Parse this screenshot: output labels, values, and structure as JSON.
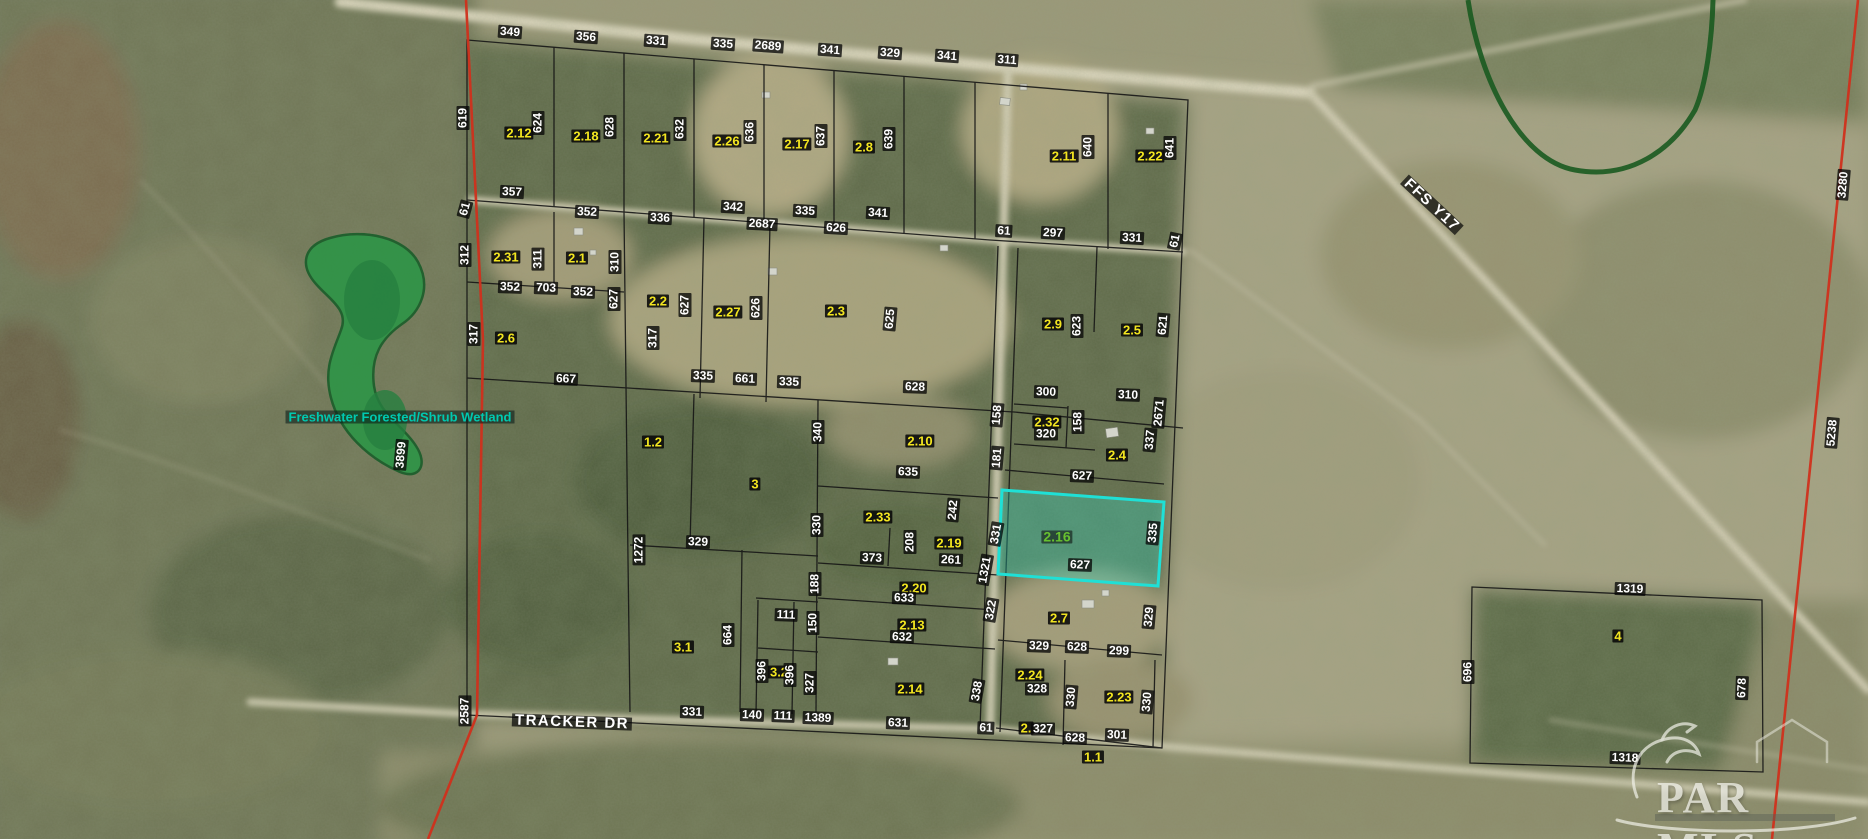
{
  "map": {
    "description": "Aerial parcel map with platted subdivision, section lines and wetland overlay",
    "highlighted_parcel": "2.16",
    "highlight_color": "#1fe0d6",
    "parcel_number_color": "#f2e520",
    "dimension_color": "#ffffff",
    "wetland": {
      "label": "Freshwater Forested/Shrub Wetland",
      "fill_color": "#2f9447",
      "label_color": "#00c9b0"
    },
    "roads": {
      "tracker": "TRACKER DR",
      "ffs": "FFS Y17"
    },
    "watermark": {
      "text": "PAR MLS"
    }
  },
  "labels": [
    {
      "t": "349",
      "x": 510,
      "y": 32,
      "r": 4,
      "s": "dim"
    },
    {
      "t": "356",
      "x": 586,
      "y": 37,
      "r": 4,
      "s": "dim"
    },
    {
      "t": "331",
      "x": 656,
      "y": 41,
      "r": 4,
      "s": "dim"
    },
    {
      "t": "335",
      "x": 723,
      "y": 44,
      "r": 4,
      "s": "dim"
    },
    {
      "t": "2689",
      "x": 768,
      "y": 46,
      "r": 4,
      "s": "dim"
    },
    {
      "t": "341",
      "x": 830,
      "y": 50,
      "r": 4,
      "s": "dim"
    },
    {
      "t": "329",
      "x": 890,
      "y": 53,
      "r": 4,
      "s": "dim"
    },
    {
      "t": "341",
      "x": 947,
      "y": 56,
      "r": 4,
      "s": "dim"
    },
    {
      "t": "311",
      "x": 1007,
      "y": 60,
      "r": 4,
      "s": "dim"
    },
    {
      "t": "619",
      "x": 463,
      "y": 118,
      "r": -90,
      "s": "dim"
    },
    {
      "t": "2.12",
      "x": 519,
      "y": 133,
      "r": 0,
      "s": "parcel"
    },
    {
      "t": "624",
      "x": 538,
      "y": 123,
      "r": -90,
      "s": "dim"
    },
    {
      "t": "2.18",
      "x": 586,
      "y": 136,
      "r": 0,
      "s": "parcel"
    },
    {
      "t": "628",
      "x": 610,
      "y": 127,
      "r": -90,
      "s": "dim"
    },
    {
      "t": "2.21",
      "x": 656,
      "y": 138,
      "r": 0,
      "s": "parcel"
    },
    {
      "t": "632",
      "x": 680,
      "y": 129,
      "r": -90,
      "s": "dim"
    },
    {
      "t": "2.26",
      "x": 727,
      "y": 141,
      "r": 0,
      "s": "parcel"
    },
    {
      "t": "636",
      "x": 750,
      "y": 132,
      "r": -90,
      "s": "dim"
    },
    {
      "t": "2.17",
      "x": 797,
      "y": 144,
      "r": 0,
      "s": "parcel"
    },
    {
      "t": "637",
      "x": 821,
      "y": 136,
      "r": -90,
      "s": "dim"
    },
    {
      "t": "2.8",
      "x": 864,
      "y": 147,
      "r": 0,
      "s": "parcel"
    },
    {
      "t": "639",
      "x": 889,
      "y": 139,
      "r": -90,
      "s": "dim"
    },
    {
      "t": "2.11",
      "x": 1064,
      "y": 156,
      "r": 0,
      "s": "parcel"
    },
    {
      "t": "640",
      "x": 1088,
      "y": 147,
      "r": -90,
      "s": "dim"
    },
    {
      "t": "2.22",
      "x": 1150,
      "y": 156,
      "r": 0,
      "s": "parcel"
    },
    {
      "t": "641",
      "x": 1170,
      "y": 148,
      "r": -90,
      "s": "dim"
    },
    {
      "t": "61",
      "x": 465,
      "y": 209,
      "r": -75,
      "s": "dim"
    },
    {
      "t": "357",
      "x": 512,
      "y": 192,
      "r": 3,
      "s": "dim"
    },
    {
      "t": "352",
      "x": 587,
      "y": 212,
      "r": 3,
      "s": "dim"
    },
    {
      "t": "336",
      "x": 660,
      "y": 218,
      "r": 3,
      "s": "dim"
    },
    {
      "t": "342",
      "x": 733,
      "y": 207,
      "r": 3,
      "s": "dim"
    },
    {
      "t": "2687",
      "x": 762,
      "y": 224,
      "r": 3,
      "s": "dim"
    },
    {
      "t": "335",
      "x": 805,
      "y": 211,
      "r": 3,
      "s": "dim"
    },
    {
      "t": "626",
      "x": 836,
      "y": 228,
      "r": 3,
      "s": "dim"
    },
    {
      "t": "341",
      "x": 878,
      "y": 213,
      "r": 3,
      "s": "dim"
    },
    {
      "t": "61",
      "x": 1004,
      "y": 231,
      "r": 3,
      "s": "dim"
    },
    {
      "t": "297",
      "x": 1053,
      "y": 233,
      "r": 3,
      "s": "dim"
    },
    {
      "t": "331",
      "x": 1132,
      "y": 238,
      "r": 3,
      "s": "dim"
    },
    {
      "t": "61",
      "x": 1175,
      "y": 241,
      "r": -78,
      "s": "dim"
    },
    {
      "t": "312",
      "x": 465,
      "y": 255,
      "r": -90,
      "s": "dim"
    },
    {
      "t": "2.31",
      "x": 506,
      "y": 257,
      "r": 0,
      "s": "parcel"
    },
    {
      "t": "311",
      "x": 538,
      "y": 259,
      "r": -90,
      "s": "dim"
    },
    {
      "t": "2.1",
      "x": 577,
      "y": 258,
      "r": 0,
      "s": "parcel"
    },
    {
      "t": "310",
      "x": 615,
      "y": 262,
      "r": -90,
      "s": "dim"
    },
    {
      "t": "352",
      "x": 510,
      "y": 287,
      "r": 2,
      "s": "dim"
    },
    {
      "t": "703",
      "x": 546,
      "y": 288,
      "r": 2,
      "s": "dim"
    },
    {
      "t": "352",
      "x": 583,
      "y": 292,
      "r": 2,
      "s": "dim"
    },
    {
      "t": "627",
      "x": 614,
      "y": 299,
      "r": -90,
      "s": "dim"
    },
    {
      "t": "2.2",
      "x": 658,
      "y": 301,
      "r": 0,
      "s": "parcel"
    },
    {
      "t": "627",
      "x": 685,
      "y": 305,
      "r": -90,
      "s": "dim"
    },
    {
      "t": "2.27",
      "x": 728,
      "y": 312,
      "r": 0,
      "s": "parcel"
    },
    {
      "t": "626",
      "x": 756,
      "y": 308,
      "r": -90,
      "s": "dim"
    },
    {
      "t": "2.3",
      "x": 836,
      "y": 311,
      "r": 0,
      "s": "parcel"
    },
    {
      "t": "625",
      "x": 890,
      "y": 319,
      "r": -85,
      "s": "dim"
    },
    {
      "t": "2.9",
      "x": 1053,
      "y": 324,
      "r": 0,
      "s": "parcel"
    },
    {
      "t": "623",
      "x": 1077,
      "y": 326,
      "r": -90,
      "s": "dim"
    },
    {
      "t": "2.5",
      "x": 1132,
      "y": 330,
      "r": 0,
      "s": "parcel"
    },
    {
      "t": "621",
      "x": 1163,
      "y": 325,
      "r": -85,
      "s": "dim"
    },
    {
      "t": "2.6",
      "x": 506,
      "y": 338,
      "r": 0,
      "s": "parcel"
    },
    {
      "t": "317",
      "x": 474,
      "y": 334,
      "r": -90,
      "s": "dim"
    },
    {
      "t": "317",
      "x": 653,
      "y": 338,
      "r": -90,
      "s": "dim"
    },
    {
      "t": "667",
      "x": 566,
      "y": 379,
      "r": 2,
      "s": "dim"
    },
    {
      "t": "335",
      "x": 703,
      "y": 376,
      "r": 2,
      "s": "dim"
    },
    {
      "t": "661",
      "x": 745,
      "y": 379,
      "r": 2,
      "s": "dim"
    },
    {
      "t": "335",
      "x": 789,
      "y": 382,
      "r": 2,
      "s": "dim"
    },
    {
      "t": "628",
      "x": 915,
      "y": 387,
      "r": 2,
      "s": "dim"
    },
    {
      "t": "300",
      "x": 1046,
      "y": 392,
      "r": 2,
      "s": "dim"
    },
    {
      "t": "310",
      "x": 1128,
      "y": 395,
      "r": 2,
      "s": "dim"
    },
    {
      "t": "2671",
      "x": 1159,
      "y": 413,
      "r": -85,
      "s": "dim"
    },
    {
      "t": "3899",
      "x": 401,
      "y": 455,
      "r": -85,
      "s": "dim"
    },
    {
      "t": "1.2",
      "x": 653,
      "y": 442,
      "r": 0,
      "s": "parcel"
    },
    {
      "t": "3",
      "x": 755,
      "y": 484,
      "r": 0,
      "s": "parcel"
    },
    {
      "t": "340",
      "x": 818,
      "y": 432,
      "r": -90,
      "s": "dim"
    },
    {
      "t": "2.10",
      "x": 920,
      "y": 441,
      "r": 0,
      "s": "parcel"
    },
    {
      "t": "635",
      "x": 908,
      "y": 472,
      "r": 2,
      "s": "dim"
    },
    {
      "t": "158",
      "x": 997,
      "y": 415,
      "r": -85,
      "s": "dim"
    },
    {
      "t": "181",
      "x": 997,
      "y": 458,
      "r": -85,
      "s": "dim"
    },
    {
      "t": "2.32",
      "x": 1047,
      "y": 422,
      "r": 0,
      "s": "parcel"
    },
    {
      "t": "320",
      "x": 1046,
      "y": 434,
      "r": 0,
      "s": "dim"
    },
    {
      "t": "158",
      "x": 1078,
      "y": 422,
      "r": -90,
      "s": "dim"
    },
    {
      "t": "2.4",
      "x": 1117,
      "y": 455,
      "r": 0,
      "s": "parcel"
    },
    {
      "t": "337",
      "x": 1150,
      "y": 440,
      "r": -85,
      "s": "dim"
    },
    {
      "t": "627",
      "x": 1082,
      "y": 476,
      "r": 2,
      "s": "dim"
    },
    {
      "t": "2.16",
      "x": 1057,
      "y": 537,
      "r": 0,
      "s": "parcel-hl"
    },
    {
      "t": "627",
      "x": 1080,
      "y": 565,
      "r": 2,
      "s": "dim"
    },
    {
      "t": "335",
      "x": 1153,
      "y": 533,
      "r": -85,
      "s": "dim"
    },
    {
      "t": "1272",
      "x": 639,
      "y": 550,
      "r": -90,
      "s": "dim"
    },
    {
      "t": "329",
      "x": 698,
      "y": 542,
      "r": 2,
      "s": "dim"
    },
    {
      "t": "330",
      "x": 817,
      "y": 525,
      "r": -90,
      "s": "dim"
    },
    {
      "t": "188",
      "x": 815,
      "y": 584,
      "r": -90,
      "s": "dim"
    },
    {
      "t": "2.33",
      "x": 878,
      "y": 517,
      "r": 0,
      "s": "parcel"
    },
    {
      "t": "242",
      "x": 953,
      "y": 510,
      "r": -85,
      "s": "dim"
    },
    {
      "t": "373",
      "x": 872,
      "y": 558,
      "r": 2,
      "s": "dim"
    },
    {
      "t": "208",
      "x": 910,
      "y": 542,
      "r": -90,
      "s": "dim"
    },
    {
      "t": "2.19",
      "x": 949,
      "y": 543,
      "r": 0,
      "s": "parcel"
    },
    {
      "t": "261",
      "x": 951,
      "y": 560,
      "r": 2,
      "s": "dim"
    },
    {
      "t": "331",
      "x": 996,
      "y": 534,
      "r": -80,
      "s": "dim"
    },
    {
      "t": "1321",
      "x": 985,
      "y": 570,
      "r": -80,
      "s": "dim"
    },
    {
      "t": "2.20",
      "x": 914,
      "y": 588,
      "r": 0,
      "s": "parcel"
    },
    {
      "t": "633",
      "x": 904,
      "y": 598,
      "r": 2,
      "s": "dim"
    },
    {
      "t": "322",
      "x": 991,
      "y": 610,
      "r": -80,
      "s": "dim"
    },
    {
      "t": "2.13",
      "x": 912,
      "y": 625,
      "r": 0,
      "s": "parcel"
    },
    {
      "t": "632",
      "x": 902,
      "y": 637,
      "r": 2,
      "s": "dim"
    },
    {
      "t": "111",
      "x": 786,
      "y": 615,
      "r": 2,
      "s": "dim"
    },
    {
      "t": "150",
      "x": 813,
      "y": 623,
      "r": -90,
      "s": "dim"
    },
    {
      "t": "3.1",
      "x": 683,
      "y": 647,
      "r": 0,
      "s": "parcel"
    },
    {
      "t": "664",
      "x": 728,
      "y": 635,
      "r": -90,
      "s": "dim"
    },
    {
      "t": "396",
      "x": 762,
      "y": 671,
      "r": -90,
      "s": "dim"
    },
    {
      "t": "3.2",
      "x": 779,
      "y": 672,
      "r": 0,
      "s": "parcel"
    },
    {
      "t": "396",
      "x": 790,
      "y": 675,
      "r": -90,
      "s": "dim"
    },
    {
      "t": "327",
      "x": 810,
      "y": 683,
      "r": -90,
      "s": "dim"
    },
    {
      "t": "2.14",
      "x": 910,
      "y": 689,
      "r": 0,
      "s": "parcel"
    },
    {
      "t": "338",
      "x": 977,
      "y": 691,
      "r": -80,
      "s": "dim"
    },
    {
      "t": "2587",
      "x": 465,
      "y": 711,
      "r": -90,
      "s": "dim"
    },
    {
      "t": "331",
      "x": 692,
      "y": 712,
      "r": 2,
      "s": "dim"
    },
    {
      "t": "140",
      "x": 752,
      "y": 715,
      "r": 2,
      "s": "dim"
    },
    {
      "t": "111",
      "x": 783,
      "y": 716,
      "r": 2,
      "s": "dim"
    },
    {
      "t": "1389",
      "x": 818,
      "y": 718,
      "r": 2,
      "s": "dim"
    },
    {
      "t": "631",
      "x": 898,
      "y": 723,
      "r": 2,
      "s": "dim"
    },
    {
      "t": "61",
      "x": 986,
      "y": 728,
      "r": 2,
      "s": "dim"
    },
    {
      "t": "2.7",
      "x": 1059,
      "y": 618,
      "r": 0,
      "s": "parcel"
    },
    {
      "t": "329",
      "x": 1149,
      "y": 617,
      "r": -85,
      "s": "dim"
    },
    {
      "t": "329",
      "x": 1039,
      "y": 646,
      "r": 2,
      "s": "dim"
    },
    {
      "t": "628",
      "x": 1077,
      "y": 647,
      "r": 2,
      "s": "dim"
    },
    {
      "t": "299",
      "x": 1119,
      "y": 651,
      "r": 2,
      "s": "dim"
    },
    {
      "t": "2.24",
      "x": 1030,
      "y": 675,
      "r": 0,
      "s": "parcel"
    },
    {
      "t": "328",
      "x": 1037,
      "y": 689,
      "r": 0,
      "s": "dim"
    },
    {
      "t": "330",
      "x": 1071,
      "y": 697,
      "r": -85,
      "s": "dim"
    },
    {
      "t": "2.23",
      "x": 1119,
      "y": 697,
      "r": 0,
      "s": "parcel"
    },
    {
      "t": "330",
      "x": 1147,
      "y": 702,
      "r": -85,
      "s": "dim"
    },
    {
      "t": "2.",
      "x": 1026,
      "y": 728,
      "r": 0,
      "s": "parcel"
    },
    {
      "t": "327",
      "x": 1043,
      "y": 729,
      "r": 0,
      "s": "dim"
    },
    {
      "t": "628",
      "x": 1075,
      "y": 738,
      "r": 2,
      "s": "dim"
    },
    {
      "t": "301",
      "x": 1117,
      "y": 735,
      "r": 2,
      "s": "dim"
    },
    {
      "t": "1.1",
      "x": 1093,
      "y": 757,
      "r": 0,
      "s": "parcel"
    },
    {
      "t": "1319",
      "x": 1630,
      "y": 589,
      "r": 2,
      "s": "dim"
    },
    {
      "t": "4",
      "x": 1618,
      "y": 636,
      "r": 0,
      "s": "parcel"
    },
    {
      "t": "696",
      "x": 1468,
      "y": 672,
      "r": -90,
      "s": "dim"
    },
    {
      "t": "1318",
      "x": 1625,
      "y": 758,
      "r": 2,
      "s": "dim"
    },
    {
      "t": "678",
      "x": 1742,
      "y": 688,
      "r": -88,
      "s": "dim"
    },
    {
      "t": "3280",
      "x": 1843,
      "y": 185,
      "r": -85,
      "s": "dim"
    },
    {
      "t": "5238",
      "x": 1832,
      "y": 433,
      "r": -85,
      "s": "dim"
    },
    {
      "t": "TRACKER DR",
      "x": 572,
      "y": 722,
      "r": 2,
      "s": "road"
    },
    {
      "t": "FFS Y17",
      "x": 1432,
      "y": 205,
      "r": 43,
      "s": "road"
    },
    {
      "t": "Freshwater Forested/Shrub Wetland",
      "x": 400,
      "y": 417,
      "r": 0,
      "s": "wetland"
    }
  ]
}
